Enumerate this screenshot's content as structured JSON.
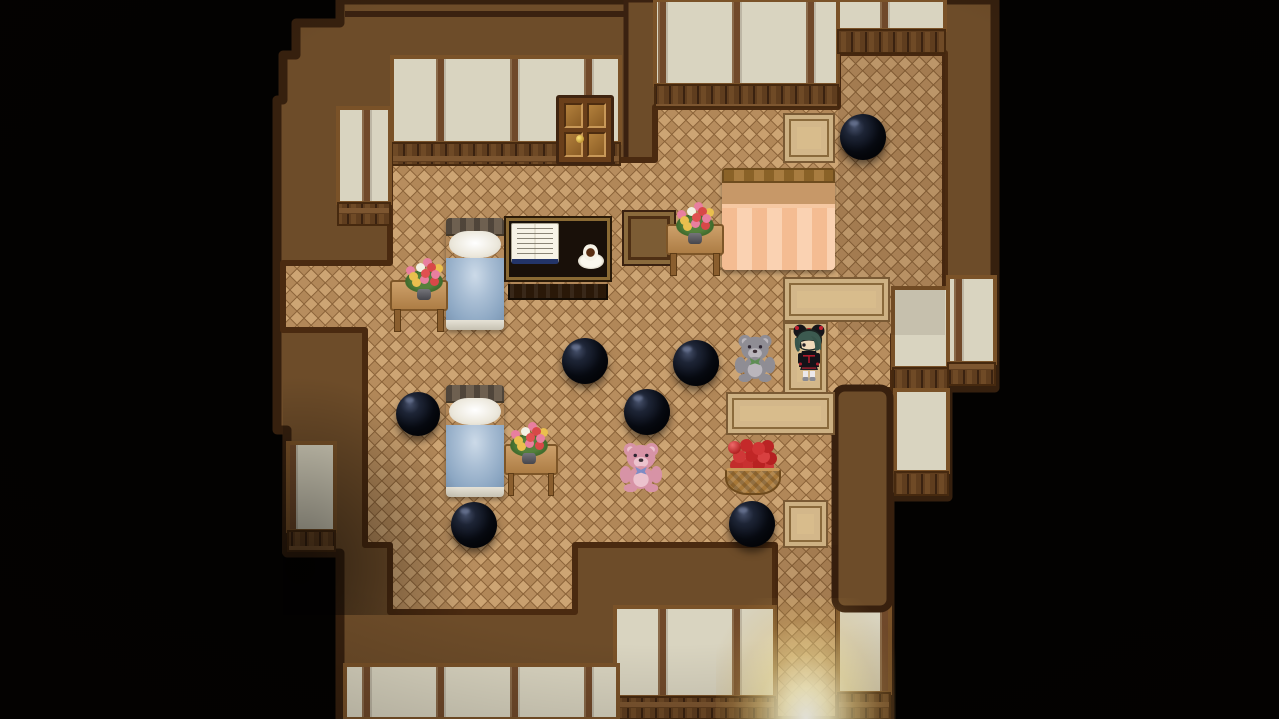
{
  "meta": {
    "domain": "game",
    "style": "RPG-Maker-like top-down house interior, night scene",
    "canvas": {
      "width": 1279,
      "height": 719
    },
    "visible_text": "none"
  },
  "palette": {
    "outside_black": "#030201",
    "wall_band_brown": "#6d4c29",
    "trim_dark": "#38200e",
    "panel_beige": "#d9d4c0",
    "panel_frame": "#7a5228",
    "wainscot": "#5f3d1e",
    "parquet_light": "#cda574",
    "parquet_dark": "#ab8355",
    "carpet_tan": "#d8bc8c",
    "orb_black": "#0a0e18",
    "bed_blanket_blue": "#a9bed4",
    "bed_blanket_orange": "#f4bc92",
    "bear_gray": "#8f8d94",
    "bear_pink": "#d793a6",
    "apple_red": "#c42a2a",
    "doorway_light": "#fffef4"
  },
  "summary": {
    "rooms": 3,
    "black_orbs": 7,
    "teddy_bears": 2,
    "beds": 3,
    "flower_tables": 3,
    "floor_mats": 3,
    "carpet_path_pieces": 3,
    "characters": 1,
    "doors": 1,
    "apple_baskets": 1,
    "desks_with_book_and_coffee": 1,
    "light_glow_at_south_exit": true
  },
  "scene": {
    "sprites": [
      {
        "type": "mat",
        "name": "floor-mat-north",
        "x": 783,
        "y": 113,
        "w": 52,
        "h": 50,
        "interactable": false
      },
      {
        "type": "mat",
        "name": "carpet-path-a",
        "x": 783,
        "y": 277,
        "w": 107,
        "h": 45,
        "interactable": false
      },
      {
        "type": "mat",
        "name": "carpet-path-b",
        "x": 783,
        "y": 322,
        "w": 45,
        "h": 74,
        "interactable": false
      },
      {
        "type": "mat",
        "name": "carpet-path-c",
        "x": 726,
        "y": 392,
        "w": 109,
        "h": 43,
        "interactable": false
      },
      {
        "type": "mat",
        "name": "floor-mat-south",
        "x": 783,
        "y": 500,
        "w": 45,
        "h": 48,
        "interactable": false
      },
      {
        "type": "mat-dark",
        "name": "floor-mat-dark",
        "x": 622,
        "y": 210,
        "w": 54,
        "h": 56,
        "interactable": false
      },
      {
        "type": "door",
        "name": "door-north",
        "x": 556,
        "y": 95,
        "w": 58,
        "h": 70,
        "interactable": true
      },
      {
        "type": "bed-orange",
        "name": "bed-orange-double",
        "x": 722,
        "y": 168,
        "w": 113,
        "h": 102,
        "interactable": true
      },
      {
        "type": "bed-blue",
        "name": "bed-blue-north",
        "x": 446,
        "y": 218,
        "w": 58,
        "h": 112,
        "interactable": true
      },
      {
        "type": "bed-blue",
        "name": "bed-blue-south",
        "x": 446,
        "y": 385,
        "w": 58,
        "h": 112,
        "interactable": true
      },
      {
        "type": "desk",
        "name": "desk-book-coffee",
        "x": 506,
        "y": 218,
        "w": 104,
        "h": 82,
        "interactable": true
      },
      {
        "type": "table",
        "name": "side-table-north",
        "x": 390,
        "y": 280,
        "w": 58,
        "h": 52,
        "interactable": true
      },
      {
        "type": "flowers",
        "name": "flower-vase-north",
        "x": 403,
        "y": 262,
        "w": 42,
        "h": 38,
        "interactable": false
      },
      {
        "type": "table",
        "name": "side-table-south",
        "x": 504,
        "y": 444,
        "w": 54,
        "h": 52,
        "interactable": true
      },
      {
        "type": "flowers",
        "name": "flower-vase-south",
        "x": 508,
        "y": 426,
        "w": 42,
        "h": 38,
        "interactable": false
      },
      {
        "type": "table",
        "name": "side-table-east",
        "x": 666,
        "y": 224,
        "w": 58,
        "h": 52,
        "interactable": true
      },
      {
        "type": "flowers",
        "name": "flower-vase-east",
        "x": 674,
        "y": 206,
        "w": 42,
        "h": 38,
        "interactable": false
      },
      {
        "type": "orb",
        "name": "black-orb-1",
        "x": 840,
        "y": 114,
        "w": 46,
        "h": 46,
        "interactable": true
      },
      {
        "type": "orb",
        "name": "black-orb-2",
        "x": 562,
        "y": 338,
        "w": 46,
        "h": 46,
        "interactable": true
      },
      {
        "type": "orb",
        "name": "black-orb-3",
        "x": 673,
        "y": 340,
        "w": 46,
        "h": 46,
        "interactable": true
      },
      {
        "type": "orb",
        "name": "black-orb-4",
        "x": 396,
        "y": 392,
        "w": 44,
        "h": 44,
        "interactable": true
      },
      {
        "type": "orb",
        "name": "black-orb-5",
        "x": 624,
        "y": 389,
        "w": 46,
        "h": 46,
        "interactable": true
      },
      {
        "type": "orb",
        "name": "black-orb-6",
        "x": 451,
        "y": 502,
        "w": 46,
        "h": 46,
        "interactable": true
      },
      {
        "type": "orb",
        "name": "black-orb-7",
        "x": 729,
        "y": 501,
        "w": 46,
        "h": 46,
        "interactable": true
      },
      {
        "type": "bear",
        "name": "teddy-bear-gray",
        "x": 733,
        "y": 330,
        "w": 44,
        "h": 52,
        "interactable": true,
        "vars": {
          "c": "#8f8d94",
          "c2": "#bab6bc",
          "bow": "#5e8e54"
        }
      },
      {
        "type": "bear",
        "name": "teddy-bear-pink",
        "x": 618,
        "y": 438,
        "w": 46,
        "h": 54,
        "interactable": true,
        "vars": {
          "c": "#d793a6",
          "c2": "#ecc2cd",
          "bow": "#7f8cc4"
        }
      },
      {
        "type": "basket",
        "name": "apple-basket",
        "x": 725,
        "y": 441,
        "w": 56,
        "h": 54,
        "interactable": true
      },
      {
        "type": "character",
        "name": "player-character",
        "x": 789,
        "y": 322,
        "w": 40,
        "h": 62,
        "interactable": true,
        "desc": "girl sprite, dark teal hair, twin black buns with red ribbons, black dress with red trim, white socks"
      },
      {
        "type": "glow",
        "name": "doorway-light-south",
        "x": 716,
        "y": 598,
        "w": 180,
        "h": 121,
        "interactable": false
      }
    ]
  }
}
